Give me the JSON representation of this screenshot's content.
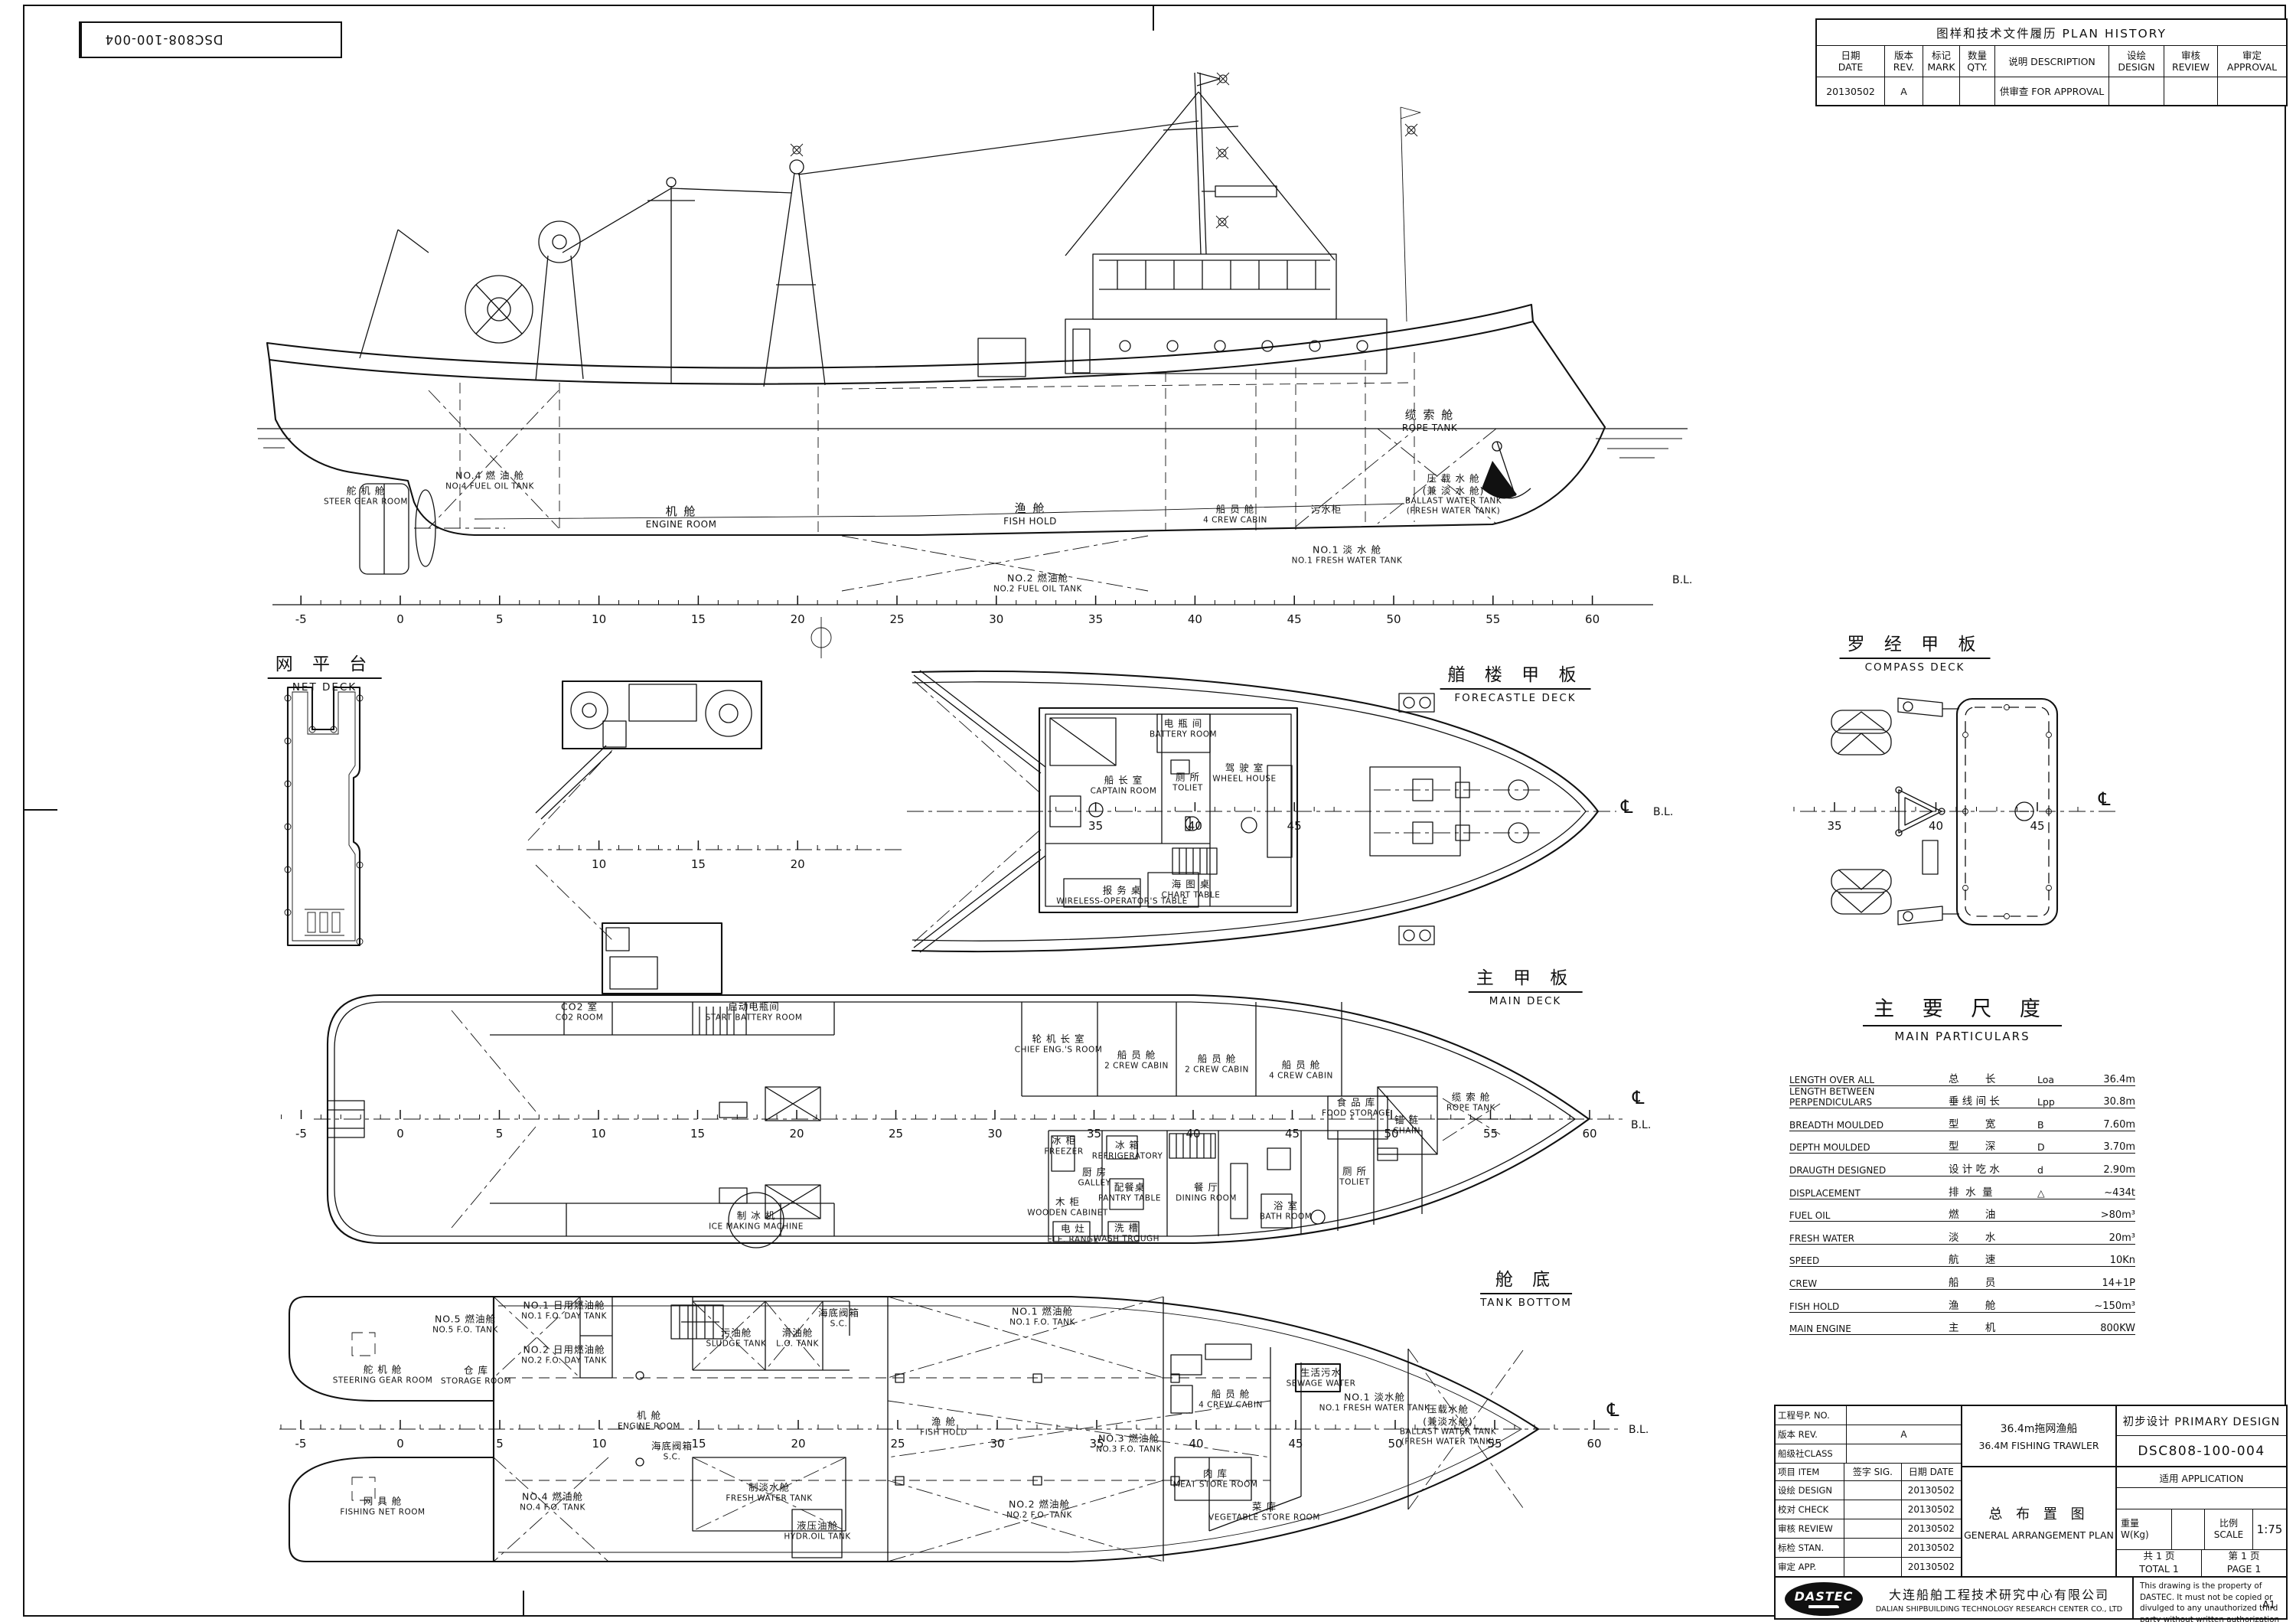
{
  "sheet": {
    "doc_no": "DSC808-100-004",
    "paper_size": "A1"
  },
  "plan_history": {
    "title": "图样和技术文件履历 PLAN  HISTORY",
    "columns": [
      {
        "cn": "日期",
        "en": "DATE"
      },
      {
        "cn": "版本",
        "en": "REV."
      },
      {
        "cn": "标记",
        "en": "MARK"
      },
      {
        "cn": "数量",
        "en": "QTY."
      },
      {
        "cn": "说明  DESCRIPTION",
        "en": ""
      },
      {
        "cn": "设绘",
        "en": "DESIGN"
      },
      {
        "cn": "审核",
        "en": "REVIEW"
      },
      {
        "cn": "审定",
        "en": "APPROVAL"
      }
    ],
    "rows": [
      {
        "date": "20130502",
        "rev": "A",
        "mark": "",
        "qty": "",
        "description": "供审查  FOR  APPROVAL",
        "design": "",
        "review": "",
        "approval": ""
      }
    ]
  },
  "views": {
    "profile": {
      "ruler": {
        "ticks": [
          -5,
          0,
          5,
          10,
          15,
          20,
          25,
          30,
          35,
          40,
          45,
          50,
          55,
          60
        ]
      },
      "bl": "B.L.",
      "labels": {
        "steer_gear": {
          "cn": "舵 机 舱",
          "en": "STEER GEAR ROOM"
        },
        "no4_fo": {
          "cn": "NO.4 燃 油 舱",
          "en": "NO.4 FUEL OIL TANK"
        },
        "engine_room": {
          "cn": "机 舱",
          "en": "ENGINE ROOM"
        },
        "fish_hold": {
          "cn": "渔 舱",
          "en": "FISH HOLD"
        },
        "crew4": {
          "cn": "船 员 舱",
          "en": "4 CREW CABIN"
        },
        "sewage_tank": {
          "cn": "污水柜",
          "en": ""
        },
        "no1_fw": {
          "cn": "NO.1 淡 水 舱",
          "en": "NO.1 FRESH WATER TANK"
        },
        "no2_fo": {
          "cn": "NO.2 燃油舱",
          "en": "NO.2 FUEL OIL TANK"
        },
        "rope_tank": {
          "cn": "缆 索 舱",
          "en": "ROPE TANK"
        },
        "ballast": {
          "cn": "压 载 水 舱",
          "cn2": "(兼 淡 水 舱)",
          "en": "BALLAST WATER TANK",
          "en2": "(FRESH WATER TANK)"
        }
      }
    },
    "net_deck": {
      "title": {
        "cn": "网 平 台",
        "en": "NET DECK"
      }
    },
    "boat_deck": {
      "ruler": {
        "ticks": [
          10,
          15,
          20
        ]
      }
    },
    "forecastle": {
      "title": {
        "cn": "艏 楼 甲 板",
        "en": "FORECASTLE DECK"
      },
      "ruler": {
        "ticks": [
          35,
          40,
          45
        ]
      },
      "cl": "℄",
      "bl": "B.L.",
      "labels": {
        "battery": {
          "cn": "电 瓶 间",
          "en": "BATTERY ROOM"
        },
        "captain": {
          "cn": "船 长 室",
          "en": "CAPTAIN ROOM"
        },
        "toilet": {
          "cn": "厕 所",
          "en": "TOLIET"
        },
        "wheel_house": {
          "cn": "驾 驶 室",
          "en": "WHEEL HOUSE"
        },
        "wireless": {
          "cn": "报 务 桌",
          "en": "WIRELESS-OPERATOR'S TABLE"
        },
        "chart": {
          "cn": "海 图 桌",
          "en": "CHART TABLE"
        }
      }
    },
    "compass_deck": {
      "title": {
        "cn": "罗 经 甲 板",
        "en": "COMPASS DECK"
      },
      "ruler": {
        "ticks": [
          35,
          40,
          45
        ]
      },
      "cl": "℄"
    },
    "main_deck": {
      "title": {
        "cn": "主 甲 板",
        "en": "MAIN DECK"
      },
      "ruler": {
        "ticks": [
          -5,
          0,
          5,
          10,
          15,
          20,
          25,
          30,
          35,
          40,
          45,
          50,
          55,
          60
        ]
      },
      "cl": "℄",
      "bl": "B.L.",
      "labels": {
        "co2": {
          "cn": "CO2 室",
          "en": "CO2 ROOM"
        },
        "start_battery": {
          "cn": "启动电瓶间",
          "en": "START BATTERY ROOM"
        },
        "ice_machine": {
          "cn": "制 冰 机",
          "en": "ICE MAKING MACHINE"
        },
        "chief_eng": {
          "cn": "轮 机 长 室",
          "en": "CHIEF ENG.'S ROOM"
        },
        "crew2a": {
          "cn": "船 员 舱",
          "en": "2 CREW CABIN"
        },
        "crew2b": {
          "cn": "船 员 舱",
          "en": "2 CREW CABIN"
        },
        "crew4": {
          "cn": "船 员 舱",
          "en": "4 CREW CABIN"
        },
        "food_storage": {
          "cn": "食 品 库",
          "en": "FOOD STORAGE"
        },
        "chain": {
          "cn": "锚 链",
          "en": "CHAIN"
        },
        "freezer": {
          "cn": "冰 柜",
          "en": "FREEZER"
        },
        "refrigerator": {
          "cn": "冰 箱",
          "en": "REFRIGERATORY"
        },
        "galley": {
          "cn": "厨 房",
          "en": "GALLEY"
        },
        "wooden_cabinet": {
          "cn": "木 柜",
          "en": "WOODEN CABINET"
        },
        "pantry": {
          "cn": "配餐桌",
          "en": "PANTRY TABLE"
        },
        "ele_range": {
          "cn": "电 灶",
          "en": "ELE. RANGE"
        },
        "wash_trough": {
          "cn": "洗 槽",
          "en": "WASH TROUGH"
        },
        "dining": {
          "cn": "餐 厅",
          "en": "DINING ROOM"
        },
        "bath": {
          "cn": "浴 室",
          "en": "BATH ROOM"
        },
        "toilet": {
          "cn": "厕 所",
          "en": "TOLIET"
        },
        "rope_tank": {
          "cn": "缆 索 舱",
          "en": "ROPE TANK"
        }
      }
    },
    "tank_bottom": {
      "title": {
        "cn": "舱 底",
        "en": "TANK BOTTOM"
      },
      "ruler": {
        "ticks": [
          -5,
          0,
          5,
          10,
          15,
          20,
          25,
          30,
          35,
          40,
          45,
          50,
          55,
          60
        ]
      },
      "cl": "℄",
      "bl": "B.L.",
      "labels": {
        "steering_gear": {
          "cn": "舵 机 舱",
          "en": "STEERING GEAR ROOM"
        },
        "fishing_net": {
          "cn": "网 具 舱",
          "en": "FISHING NET ROOM"
        },
        "storage": {
          "cn": "仓 库",
          "en": "STORAGE ROOM"
        },
        "no5_fo": {
          "cn": "NO.5 燃油舱",
          "en": "NO.5 F.O. TANK"
        },
        "no1_day": {
          "cn": "NO.1 日用燃油舱",
          "en": "NO.1 F.O. DAY TANK"
        },
        "no2_day": {
          "cn": "NO.2 日用燃油舱",
          "en": "NO.2 F.O. DAY TANK"
        },
        "no4_fo": {
          "cn": "NO.4 燃油舱",
          "en": "NO.4 F.O. TANK"
        },
        "engine_room": {
          "cn": "机 舱",
          "en": "ENGINE ROOM"
        },
        "sludge": {
          "cn": "污油舱",
          "en": "SLUDGE TANK"
        },
        "lo_tank": {
          "cn": "滑油舱",
          "en": "L.O. TANK"
        },
        "sc1": {
          "cn": "海底阀箱",
          "en": "S.C."
        },
        "sc2": {
          "cn": "海底阀箱",
          "en": "S.C."
        },
        "fw_generator": {
          "cn": "制淡水舱",
          "en": "FRESH WATER TANK"
        },
        "hydr_oil": {
          "cn": "液压油舱",
          "en": "HYDR.OIL TANK"
        },
        "no1_fo": {
          "cn": "NO.1 燃油舱",
          "en": "NO.1 F.O. TANK"
        },
        "fish_hold": {
          "cn": "渔 舱",
          "en": "FISH HOLD"
        },
        "no3_fo": {
          "cn": "NO.3 燃油舱",
          "en": "NO.3 F.O. TANK"
        },
        "no2_fo": {
          "cn": "NO.2 燃油舱",
          "en": "NO.2 F.O. TANK"
        },
        "crew4": {
          "cn": "船 员 舱",
          "en": "4 CREW CABIN"
        },
        "sewage": {
          "cn": "生活污水",
          "en": "SEWAGE WATER"
        },
        "no1_fw": {
          "cn": "NO.1 淡水舱",
          "en": "NO.1 FRESH WATER TANK"
        },
        "ballast": {
          "cn": "压载水舱",
          "cn2": "(兼淡水舱)",
          "en": "BALLAST WATER TANK",
          "en2": "(FRESH WATER TANK)"
        },
        "meat": {
          "cn": "肉 库",
          "en": "MEAT STORE ROOM"
        },
        "veg": {
          "cn": "菜 库",
          "en": "VEGETABLE STORE ROOM"
        }
      }
    }
  },
  "main_particulars": {
    "title_cn": "主 要 尺 度",
    "title_en": "MAIN PARTICULARS",
    "rows": [
      {
        "en": "LENGTH OVER ALL",
        "cn": "总        长",
        "sym": "Loa",
        "val": "36.4m"
      },
      {
        "en": "LENGTH BETWEEN PERPENDICULARS",
        "cn": "垂 线 间 长",
        "sym": "Lpp",
        "val": "30.8m"
      },
      {
        "en": "BREADTH MOULDED",
        "cn": "型        宽",
        "sym": "B",
        "val": "7.60m"
      },
      {
        "en": "DEPTH MOULDED",
        "cn": "型        深",
        "sym": "D",
        "val": "3.70m"
      },
      {
        "en": "DRAUGTH DESIGNED",
        "cn": "设 计 吃 水",
        "sym": "d",
        "val": "2.90m"
      },
      {
        "en": "DISPLACEMENT",
        "cn": "排  水  量",
        "sym": "△",
        "val": "~434t"
      },
      {
        "en": "FUEL OIL",
        "cn": "燃        油",
        "sym": "",
        "val": ">80m³"
      },
      {
        "en": "FRESH WATER",
        "cn": "淡        水",
        "sym": "",
        "val": "20m³"
      },
      {
        "en": "SPEED",
        "cn": "航        速",
        "sym": "",
        "val": "10Kn"
      },
      {
        "en": "CREW",
        "cn": "船        员",
        "sym": "",
        "val": "14+1P"
      },
      {
        "en": "FISH HOLD",
        "cn": "渔        舱",
        "sym": "",
        "val": "~150m³"
      },
      {
        "en": "MAIN ENGINE",
        "cn": "主        机",
        "sym": "",
        "val": "800KW"
      }
    ]
  },
  "title_block": {
    "p_no_label": "工程号P. NO.",
    "p_no": "",
    "rev_label": "版本 REV.",
    "rev": "A",
    "class_label": "船级社CLASS",
    "class": "",
    "item_label": "项目 ITEM",
    "sig_label": "签字 SIG.",
    "date_label": "日期 DATE",
    "sign_rows": [
      {
        "label": "设绘 DESIGN",
        "sig": "",
        "date": "20130502"
      },
      {
        "label": "校对 CHECK",
        "sig": "",
        "date": "20130502"
      },
      {
        "label": "审核 REVIEW",
        "sig": "",
        "date": "20130502"
      },
      {
        "label": "标检 STAN.",
        "sig": "",
        "date": "20130502"
      },
      {
        "label": "审定 APP.",
        "sig": "",
        "date": "20130502"
      }
    ],
    "ship_cn": "36.4m拖网渔船",
    "ship_en": "36.4M  FISHING  TRAWLER",
    "drawing_cn": "总 布 置 图",
    "drawing_en": "GENERAL  ARRANGEMENT  PLAN",
    "stage": "初步设计  PRIMARY  DESIGN",
    "dwg_no": "DSC808-100-004",
    "app_label": "适用 APPLICATION",
    "application": "",
    "weight_cn": "重量",
    "weight_en": "W(Kg)",
    "weight": "",
    "scale_cn": "比例",
    "scale_en": "SCALE",
    "scale_val": "1:75",
    "total_cn": "共 1 页",
    "total_en": "TOTAL 1",
    "page_cn": "第 1 页",
    "page_en": "PAGE 1",
    "logo_text": "DASTEC",
    "company_cn": "大连船舶工程技术研究中心有限公司",
    "company_en": "DALIAN  SHIPBUILDING  TECHNOLOGY  RESEARCH  CENTER  CO.,  LTD",
    "note": "This drawing is the property of DASTEC. It must not be copied or divulged to any unauthorized third party without written authorization from DASTEC.",
    "format": "A1"
  }
}
